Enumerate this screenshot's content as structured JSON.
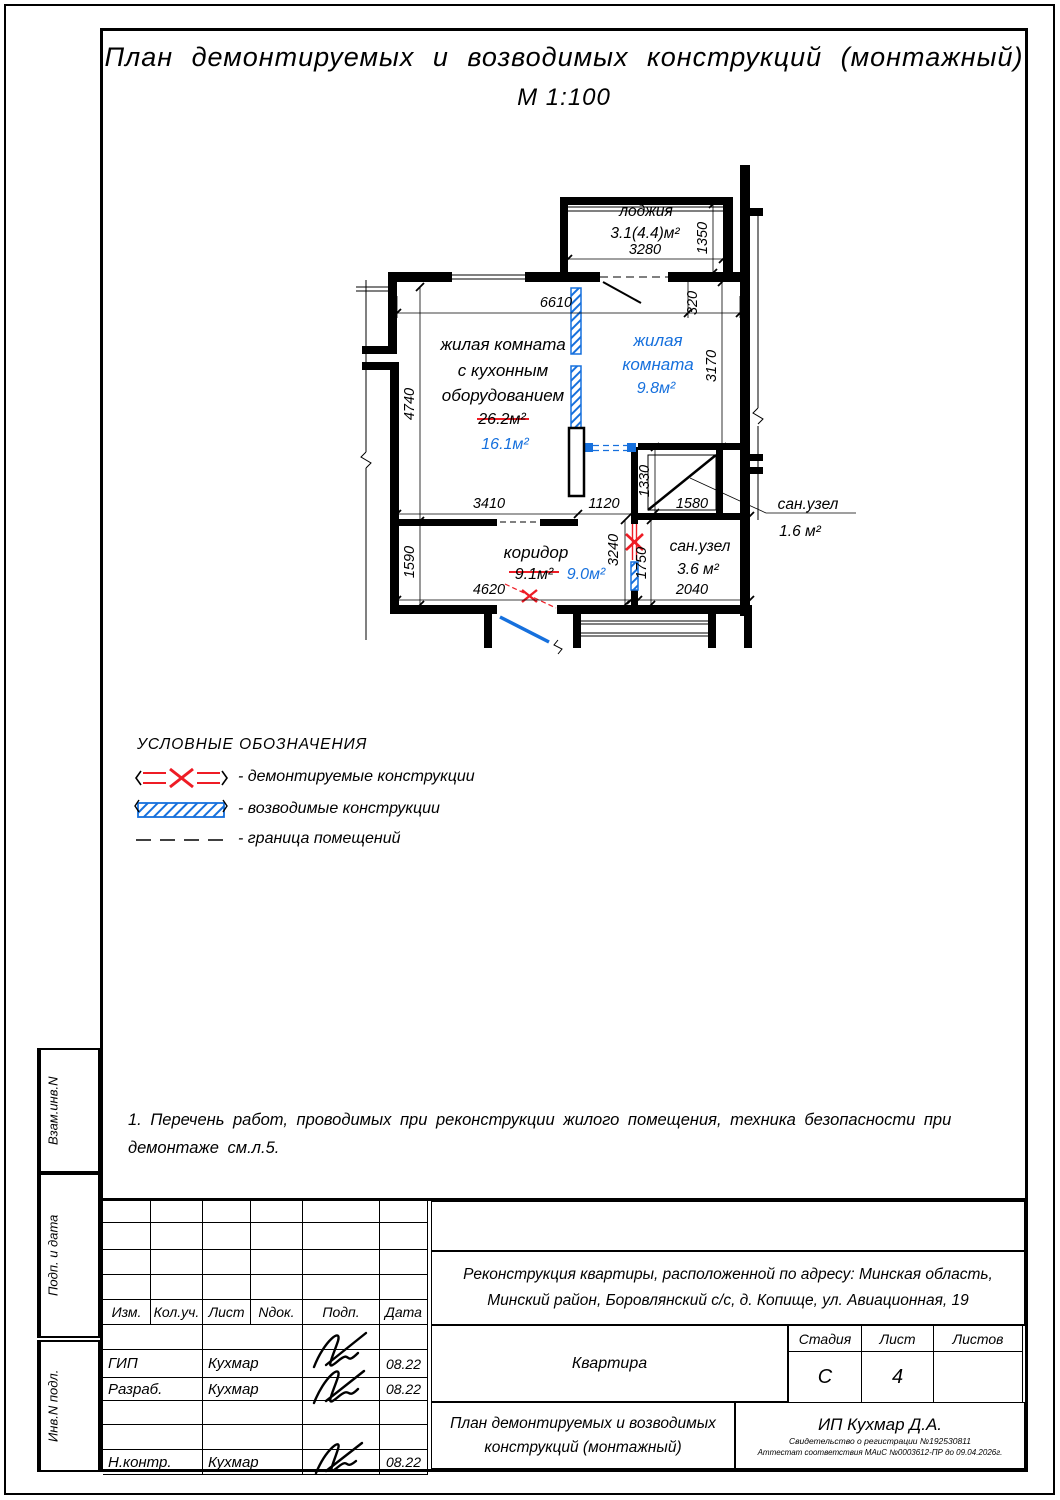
{
  "header": {
    "title": "План демонтируемых и возводимых конструкций (монтажный)",
    "scale": "М 1:100"
  },
  "plan": {
    "rooms": {
      "living_kitchen": {
        "line1": "жилая комната",
        "line2": "с кухонным",
        "line3": "оборудованием",
        "area_old": "26.2м²",
        "area_new": "16.1м²"
      },
      "living": {
        "line1": "жилая",
        "line2": "комната",
        "area": "9.8м²"
      },
      "loggia": {
        "name": "лоджия",
        "area": "3.1(4.4)м²"
      },
      "corridor": {
        "name": "коридор",
        "area_old": "9.1м²",
        "area_new": "9.0м²"
      },
      "bath_big": {
        "name": "сан.узел",
        "area": "3.6 м²"
      },
      "bath_small": {
        "name": "сан.узел",
        "area": "1.6 м²"
      }
    },
    "dims": {
      "d6610": "6610",
      "d320": "320",
      "d3280": "3280",
      "d1350": "1350",
      "d3170": "3170",
      "d4740": "4740",
      "d1590": "1590",
      "d3410": "3410",
      "d1120": "1120",
      "d1330": "1330",
      "d1580": "1580",
      "d3240": "3240",
      "d1750": "1750",
      "d4620": "4620",
      "d2040": "2040"
    }
  },
  "legend": {
    "header": "УСЛОВНЫЕ ОБОЗНАЧЕНИЯ",
    "demolished": "- демонтируемые конструкции",
    "erected": "- возводимые конструкции",
    "boundary": "- граница помещений"
  },
  "notes": {
    "line1": "1. Перечень работ, проводимых при реконструкции жилого помещения, техника безопасности при",
    "line2": "демонтаже см.л.5."
  },
  "side_stamps": {
    "s1": "Взам.инв.N",
    "s2": "Подп. и дата",
    "s3": "Инв.N подл."
  },
  "title_block": {
    "columns": [
      "Изм.",
      "Кол.уч.",
      "Лист",
      "Nдок.",
      "Подп.",
      "Дата"
    ],
    "rows": [
      {
        "role": "ГИП",
        "name": "Кухмар",
        "date": "08.22"
      },
      {
        "role": "Разраб.",
        "name": "Кухмар",
        "date": "08.22"
      },
      {
        "role": "Н.контр.",
        "name": "Кухмар",
        "date": "08.22"
      }
    ],
    "project_line1": "Реконструкция квартиры, расположенной по адресу: Минская область,",
    "project_line2": "Минский район, Боровлянский с/с, д. Копище, ул. Авиационная, 19",
    "object_name": "Квартира",
    "stage_label": "Стадия",
    "sheet_label": "Лист",
    "sheets_label": "Листов",
    "stage": "С",
    "sheet": "4",
    "sheets": "",
    "drawing_line1": "План демонтируемых и возводимых",
    "drawing_line2": "конструкций (монтажный)",
    "company": "ИП Кухмар Д.А.",
    "cert_line1": "Свидетельство о регистрации №192530811",
    "cert_line2": "Аттестат соответствия МАиС №0003612-ПР до 09.04.2026г."
  },
  "colors": {
    "demolished": "#ee1c25",
    "erected": "#1670dd"
  }
}
